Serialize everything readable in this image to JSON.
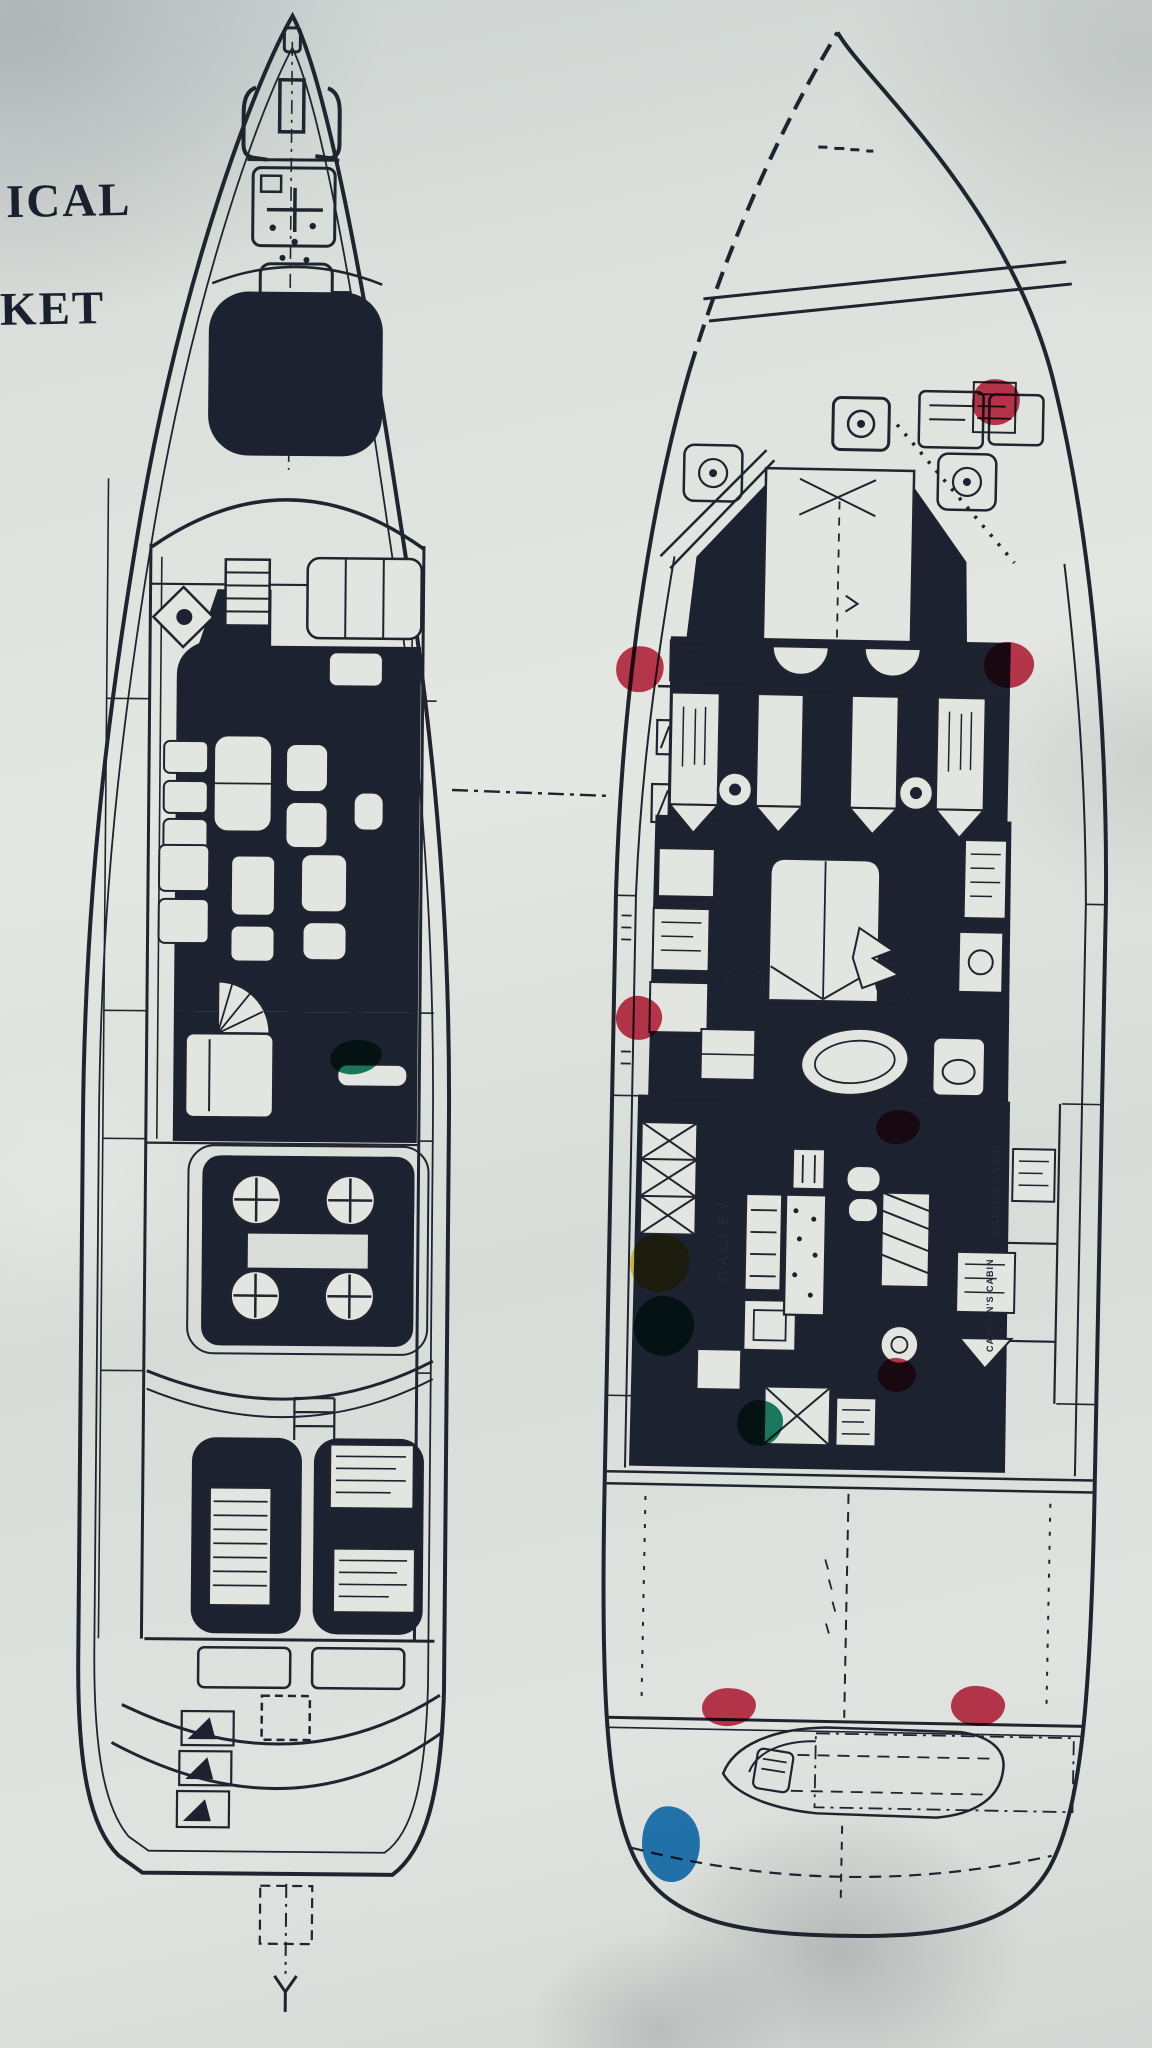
{
  "photo": {
    "description": "Photocopy of a motor-yacht general arrangement: two deck plans side by side, annotated with colored marker dots",
    "paper_hex": "#dce0dc",
    "ink_hex": "#20242f"
  },
  "margin_text": {
    "line1": "ICAL",
    "line2": "KET"
  },
  "plan_labels": {
    "galley": "GALLEY",
    "crew_cabin": "CREW'S CABIN",
    "captains_cabin": "CAPTAIN'S CABIN"
  },
  "marker_palette": {
    "red": "#c92f4a",
    "yellow": "#e7cf3f",
    "green": "#107c62",
    "blue": "#1b79c0"
  },
  "markers": [
    {
      "id": "red-1",
      "color": "red",
      "hex": "#c92f4a",
      "x": 972,
      "y": 379,
      "w": 48,
      "h": 46,
      "rot": -4
    },
    {
      "id": "red-2",
      "color": "red",
      "hex": "#c92f4a",
      "x": 616,
      "y": 646,
      "w": 48,
      "h": 46,
      "rot": -10
    },
    {
      "id": "red-3",
      "color": "red",
      "hex": "#c92f4a",
      "x": 984,
      "y": 642,
      "w": 50,
      "h": 46,
      "rot": 5
    },
    {
      "id": "red-4",
      "color": "red",
      "hex": "#c92f4a",
      "x": 616,
      "y": 996,
      "w": 46,
      "h": 44,
      "rot": 8
    },
    {
      "id": "red-5",
      "color": "red",
      "hex": "#c92f4a",
      "x": 876,
      "y": 1110,
      "w": 44,
      "h": 34,
      "rot": -6
    },
    {
      "id": "red-6",
      "color": "red",
      "hex": "#c92f4a",
      "x": 878,
      "y": 1358,
      "w": 38,
      "h": 34,
      "rot": 4
    },
    {
      "id": "red-7",
      "color": "red",
      "hex": "#c92f4a",
      "x": 702,
      "y": 1688,
      "w": 54,
      "h": 38,
      "rot": -3
    },
    {
      "id": "red-8",
      "color": "red",
      "hex": "#c92f4a",
      "x": 951,
      "y": 1686,
      "w": 54,
      "h": 40,
      "rot": 3
    },
    {
      "id": "yellow-1",
      "color": "yellow",
      "hex": "#e7cf3f",
      "x": 630,
      "y": 1234,
      "w": 60,
      "h": 58,
      "rot": -6
    },
    {
      "id": "green-1",
      "color": "green",
      "hex": "#107c62",
      "x": 634,
      "y": 1296,
      "w": 60,
      "h": 60,
      "rot": 7
    },
    {
      "id": "green-2",
      "color": "green",
      "hex": "#107c62",
      "x": 737,
      "y": 1400,
      "w": 46,
      "h": 46,
      "rot": 0
    },
    {
      "id": "green-3",
      "color": "green",
      "hex": "#0f7d5a",
      "x": 330,
      "y": 1040,
      "w": 52,
      "h": 34,
      "rot": -8
    },
    {
      "id": "blue-1",
      "color": "blue",
      "hex": "#1b79c0",
      "x": 642,
      "y": 1806,
      "w": 58,
      "h": 76,
      "rot": -5
    }
  ]
}
